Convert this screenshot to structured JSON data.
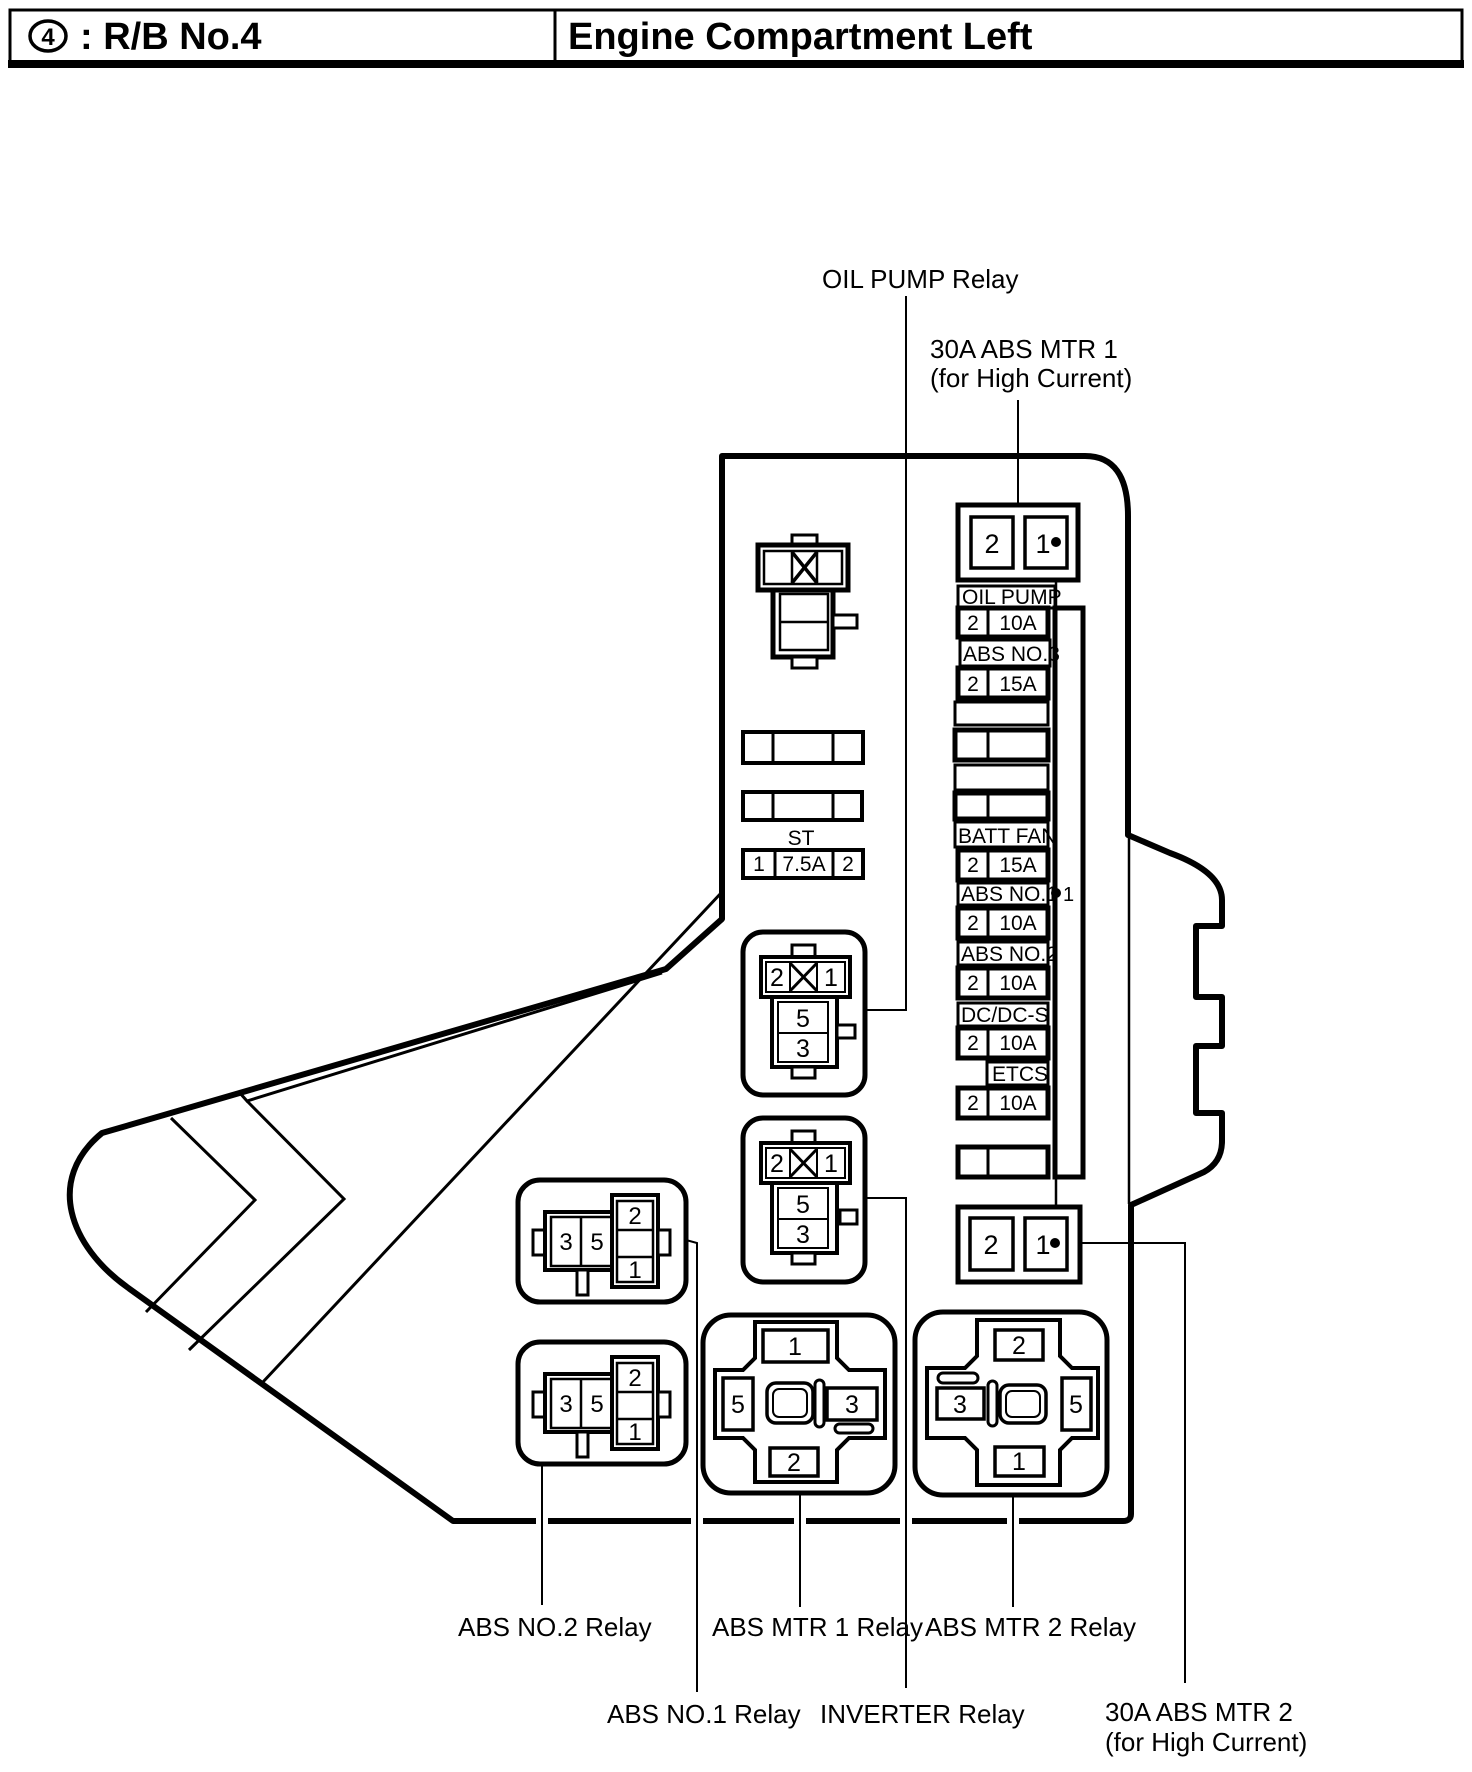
{
  "header": {
    "badge_number": "4",
    "left_title": ": R/B No.4",
    "right_title": "Engine Compartment Left"
  },
  "callouts": {
    "oil_pump_relay": "OIL PUMP Relay",
    "abs_mtr1_fuse_line1": "30A ABS MTR 1",
    "abs_mtr1_fuse_line2": "(for High Current)",
    "abs_no2_relay": "ABS NO.2 Relay",
    "abs_no1_relay": "ABS NO.1 Relay",
    "abs_mtr1_relay": "ABS MTR 1 Relay",
    "inverter_relay": "INVERTER Relay",
    "abs_mtr2_relay": "ABS MTR 2 Relay",
    "abs_mtr2_fuse_line1": "30A ABS MTR 2",
    "abs_mtr2_fuse_line2": "(for High Current)"
  },
  "fuse_box": {
    "top_connector": {
      "pin_left": "2",
      "pin_right": "1"
    },
    "bottom_connector": {
      "pin_left": "2",
      "pin_right": "1"
    },
    "node_marker": "1",
    "fuse_rows": [
      {
        "label": "OIL PUMP",
        "pin": "2",
        "amp": "10A"
      },
      {
        "label": "ABS NO.3",
        "pin": "2",
        "amp": "15A"
      },
      {
        "label": "",
        "pin": "",
        "amp": ""
      },
      {
        "label": "",
        "pin": "",
        "amp": ""
      },
      {
        "label": "BATT FAN",
        "pin": "2",
        "amp": "15A"
      },
      {
        "label": "ABS NO.1",
        "pin": "2",
        "amp": "10A"
      },
      {
        "label": "ABS NO.2",
        "pin": "2",
        "amp": "10A"
      },
      {
        "label": "DC/DC-S",
        "pin": "2",
        "amp": "10A"
      },
      {
        "label": "ETCS",
        "pin": "2",
        "amp": "10A"
      },
      {
        "label": "",
        "pin": "",
        "amp": ""
      }
    ],
    "st_fuse": {
      "label": "ST",
      "pin_left": "1",
      "amp": "7.5A",
      "pin_right": "2"
    },
    "oil_pump_relay_pins": {
      "top_left": "2",
      "top_right": "1",
      "mid": "5",
      "bottom": "3"
    },
    "inverter_relay_pins": {
      "top_left": "2",
      "top_right": "1",
      "mid": "5",
      "bottom": "3"
    },
    "abs_no1_relay_pins": {
      "a": "3",
      "b": "5",
      "c": "2",
      "d": "1"
    },
    "abs_no2_relay_pins": {
      "a": "3",
      "b": "5",
      "c": "2",
      "d": "1"
    },
    "abs_mtr1_relay_pins": {
      "top": "1",
      "left": "5",
      "right": "3",
      "bottom": "2"
    },
    "abs_mtr2_relay_pins": {
      "top": "2",
      "left": "3",
      "right": "5",
      "bottom": "1"
    }
  },
  "colors": {
    "line": "#000000",
    "background": "#ffffff"
  }
}
